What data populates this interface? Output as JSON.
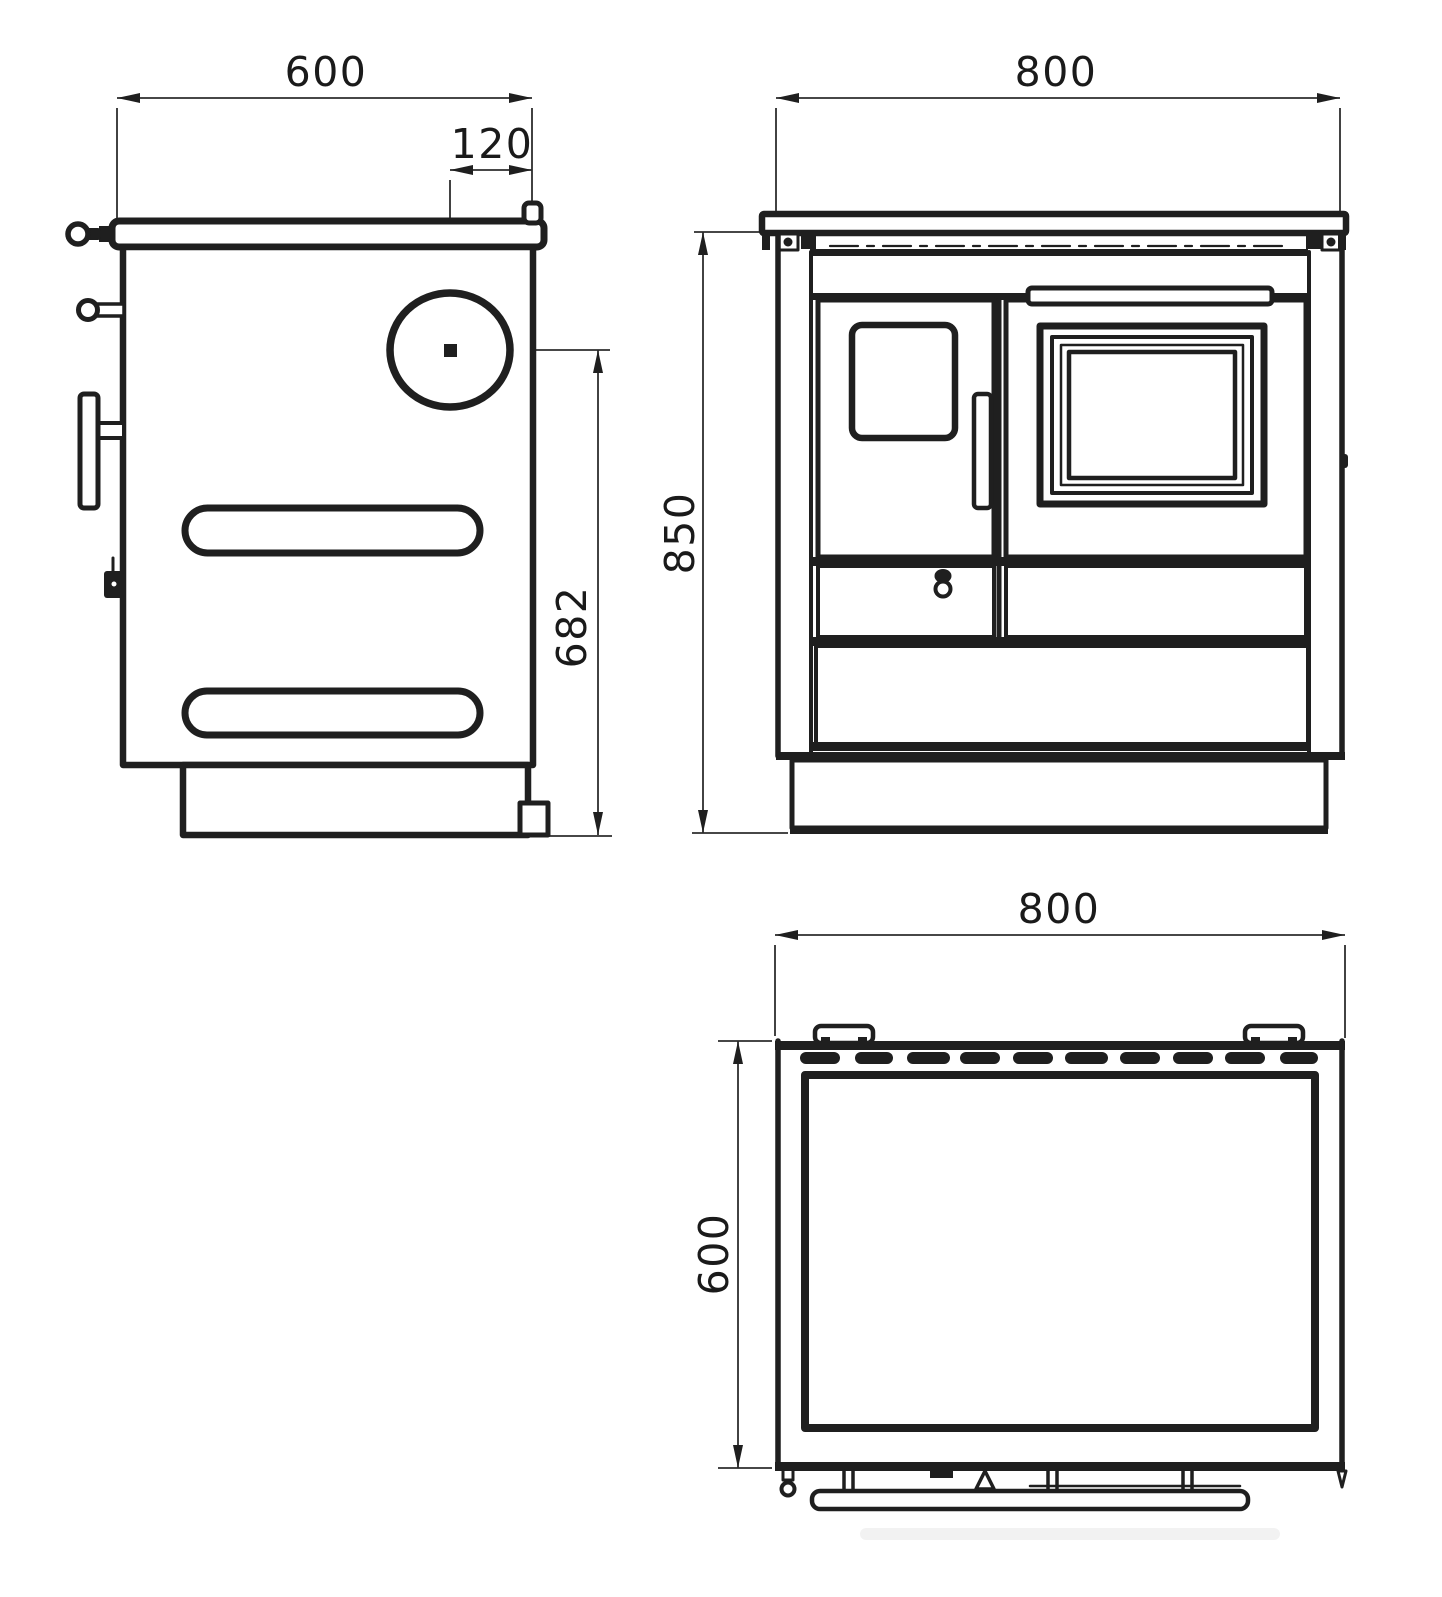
{
  "drawing": {
    "type": "technical-dimension-drawing",
    "subject": "solid-fuel cooking stove, three orthographic views",
    "background_color": "#ffffff",
    "line_color": "#1f1f1f",
    "dimension_line_color": "#2d2d2d",
    "side_view": {
      "width_label": "600",
      "flue_offset_label": "120",
      "flue_center_height_label": "682"
    },
    "front_view": {
      "width_label": "800",
      "height_label": "850"
    },
    "top_view": {
      "width_label": "800",
      "depth_label": "600"
    }
  }
}
